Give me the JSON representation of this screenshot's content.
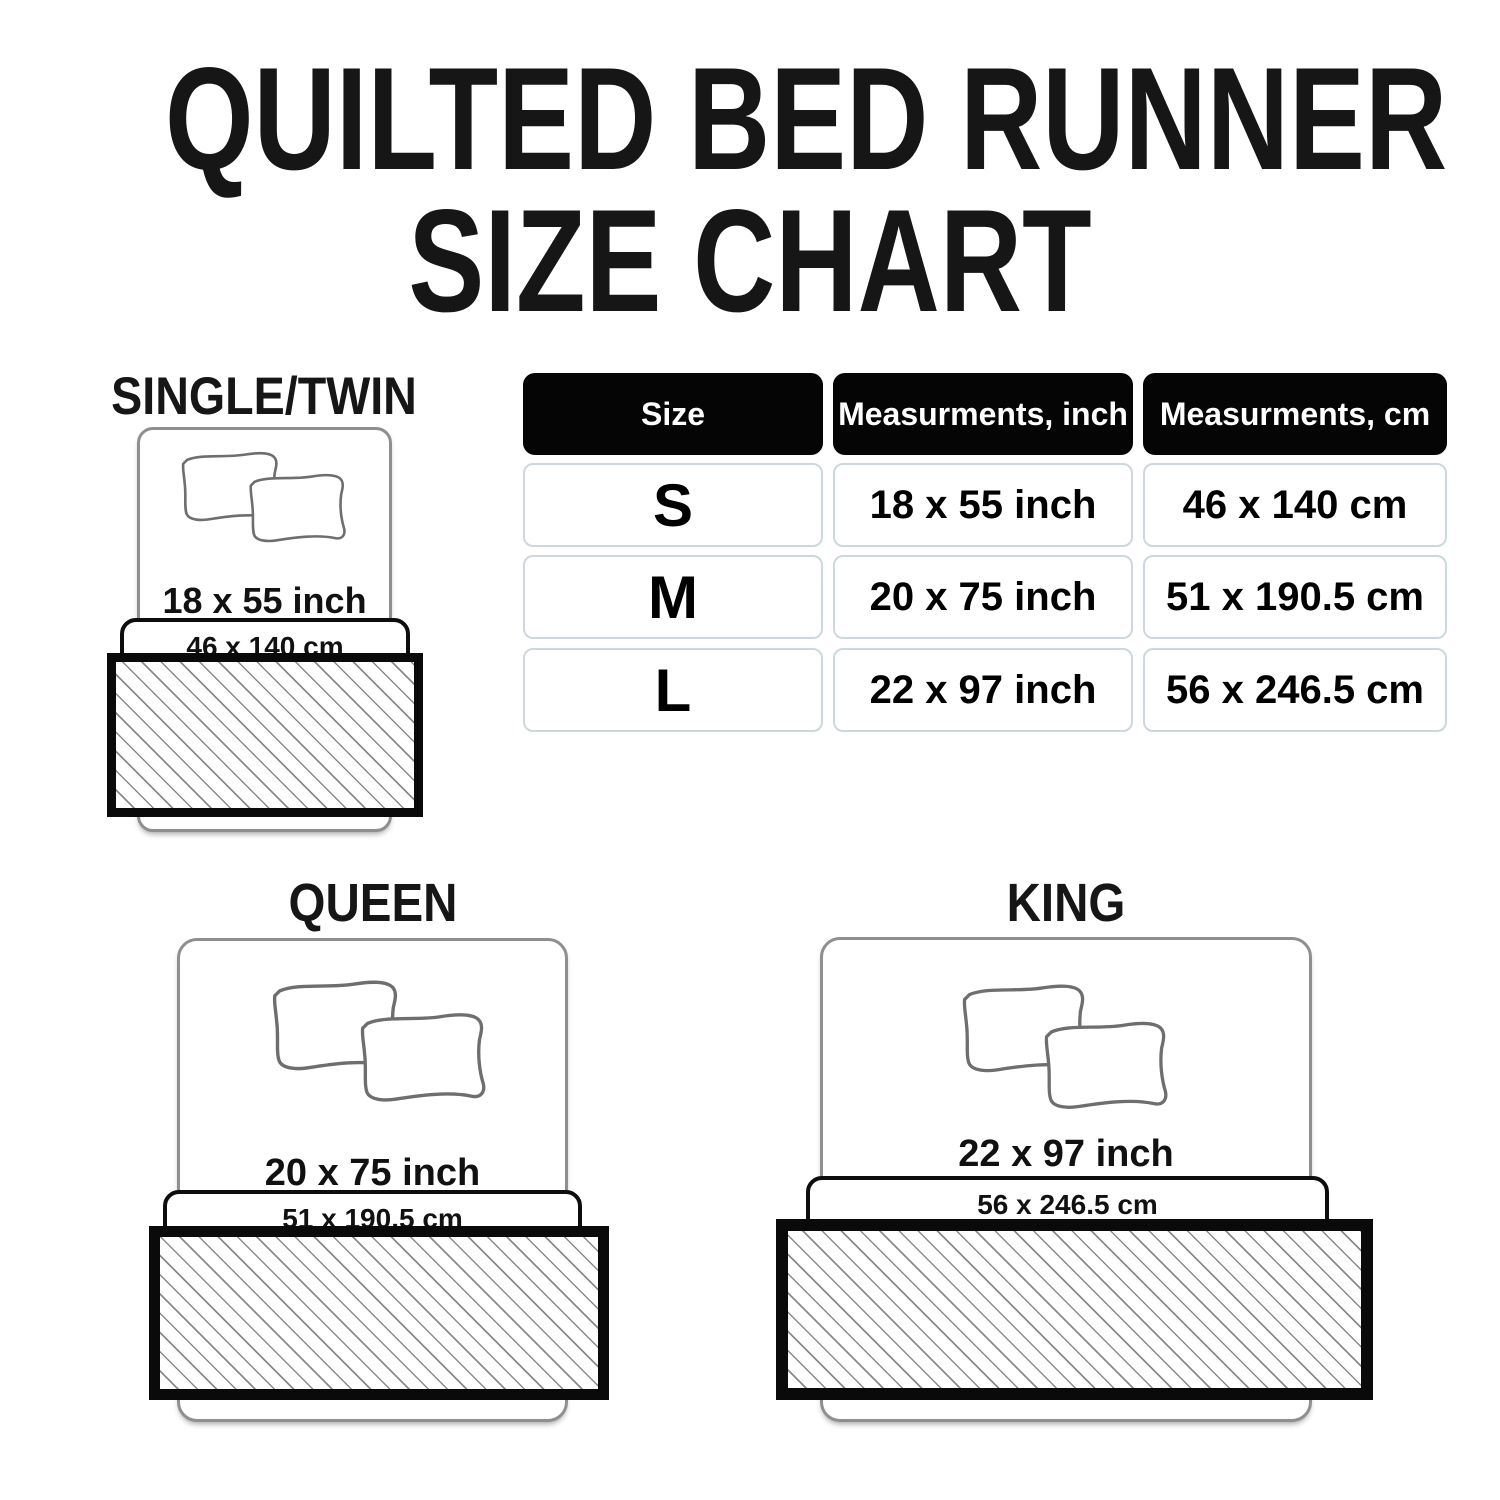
{
  "title": {
    "line1": "QUILTED BED RUNNER",
    "line2": "SIZE CHART"
  },
  "table": {
    "headers": {
      "size": "Size",
      "inch": "Measurments, inch",
      "cm": "Measurments, cm"
    },
    "rows": [
      {
        "size": "S",
        "inch": "18 x 55 inch",
        "cm": "46 x 140 cm"
      },
      {
        "size": "M",
        "inch": "20 x 75 inch",
        "cm": "51 x 190.5 cm"
      },
      {
        "size": "L",
        "inch": "22 x 97 inch",
        "cm": "56 x 246.5 cm"
      }
    ]
  },
  "diagrams": {
    "single": {
      "label": "SINGLE/TWIN",
      "inch": "18 x 55 inch",
      "cm": "46 x 140 cm"
    },
    "queen": {
      "label": "QUEEN",
      "inch": "20 x 75 inch",
      "cm": "51 x 190.5 cm"
    },
    "king": {
      "label": "KING",
      "inch": "22 x 97 inch",
      "cm": "56 x 246.5 cm"
    }
  },
  "icons": {
    "pillow": "pillow-icon",
    "runner_swatch": "diagonal-hatch-swatch"
  },
  "colors": {
    "background": "#ffffff",
    "text": "#161616",
    "table_header_bg": "#050505",
    "table_header_text": "#ffffff",
    "table_cell_border": "#ccd8dc",
    "bed_outline": "#8f8f8f",
    "pillow_outline": "#6e6e6e",
    "runner_border": "#0a0a0a",
    "hatch_line": "#8a8a8a"
  }
}
